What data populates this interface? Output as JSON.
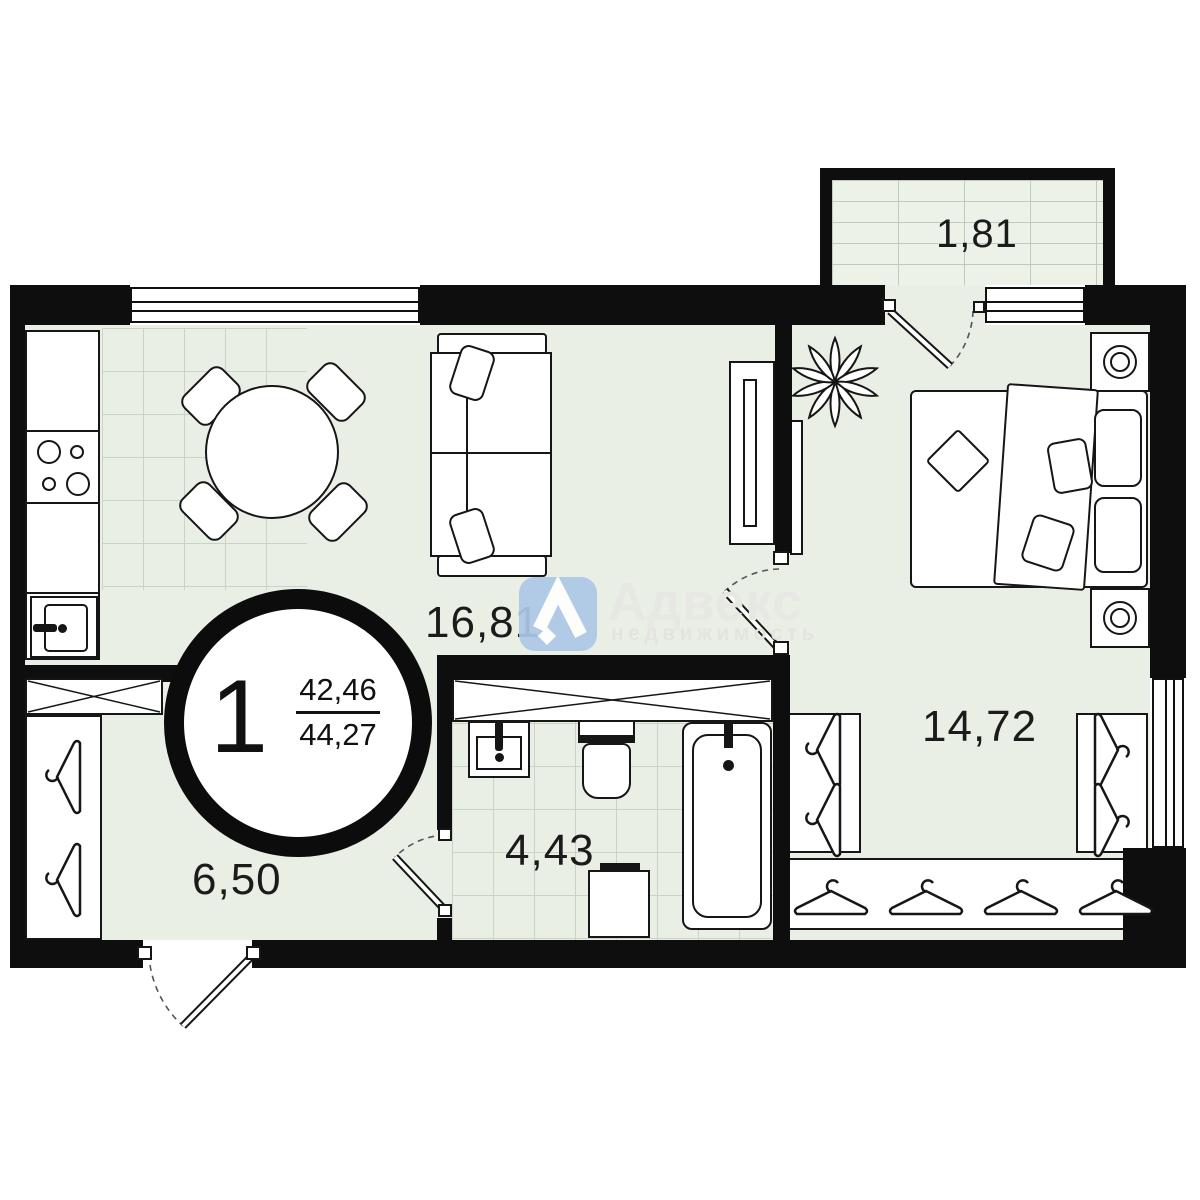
{
  "watermark": {
    "brand": "Адвекс",
    "subtitle": "недвижимость",
    "logo_color": "#adc9e8"
  },
  "badge": {
    "rooms_count": "1",
    "living_area": "42,46",
    "total_area": "44,27"
  },
  "areas": {
    "living_room": "16,81",
    "bedroom": "14,72",
    "hallway": "6,50",
    "bathroom": "4,43",
    "balcony": "1,81"
  },
  "colors": {
    "wall": "#0e0e0e",
    "floor": "#e9efe4",
    "tile_line": "#c9d4c3",
    "brick_line": "#bfcbb8",
    "label_text": "#1b1b1b",
    "watermark_text": "#e7e7e3"
  }
}
